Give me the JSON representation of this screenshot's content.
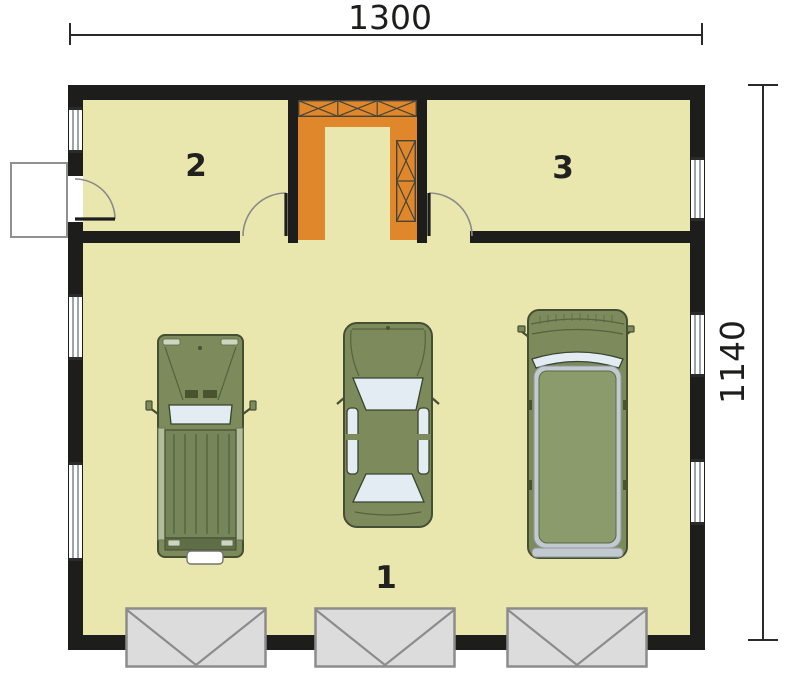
{
  "floor_plan": {
    "dimensions": {
      "top": "1300",
      "right": "1140"
    },
    "rooms": [
      {
        "name": "room-2",
        "label": "2"
      },
      {
        "name": "room-3",
        "label": "3"
      },
      {
        "name": "garage",
        "label": "1"
      }
    ],
    "vehicles": [
      {
        "name": "pickup-truck"
      },
      {
        "name": "sedan-car"
      },
      {
        "name": "van"
      }
    ],
    "features": {
      "garage_doors": 3,
      "windows_left_wall": 3,
      "windows_right_wall": 3,
      "stair_block": "u-shaped",
      "entry_door_side": "left"
    },
    "colors": {
      "background": "#ffffff",
      "floor": "#eae7ae",
      "wall": "#1d1d1b",
      "stairs": "#e0872c",
      "garage_door_fill": "#dcdcdc",
      "garage_door_line": "#8c8c8c",
      "vehicle_body": "#7d8a5b",
      "vehicle_dark": "#454f33",
      "vehicle_glass": "#e3ecf3",
      "van_roof": "#8c9b6b",
      "trim_silver": "#c3cacf",
      "dimension": "#2a2a2a"
    }
  }
}
